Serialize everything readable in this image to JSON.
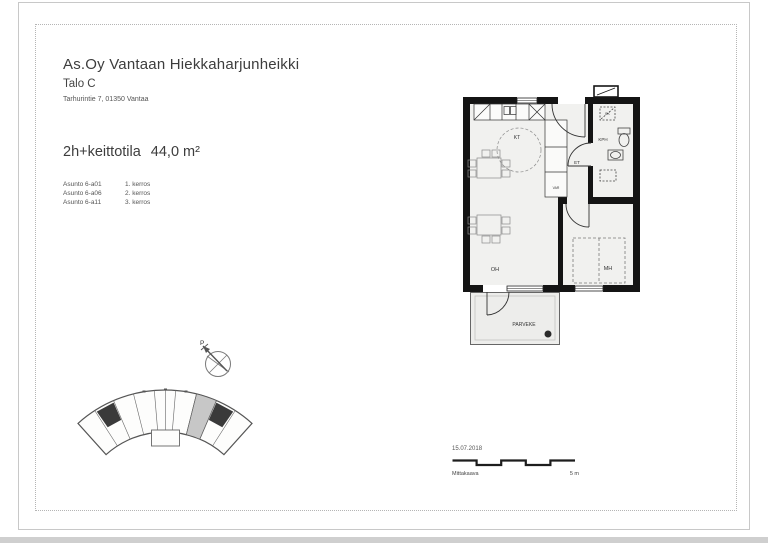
{
  "header": {
    "company": "As.Oy Vantaan Hiekkaharjunheikki",
    "building": "Talo C",
    "address": "Tarhurintie 7,  01350 Vantaa"
  },
  "apartment": {
    "type": "2h+keittotila",
    "area": "44,0 m²",
    "units": [
      {
        "name": "Asunto 6-a01",
        "floor": "1. kerros"
      },
      {
        "name": "Asunto 6-a06",
        "floor": "2. kerros"
      },
      {
        "name": "Asunto 6-a11",
        "floor": "3. kerros"
      }
    ]
  },
  "floorplan": {
    "rooms": {
      "kitchen": "KT",
      "hall": "ET",
      "bathroom": "KPH",
      "living_room": "OH",
      "bedroom": "MH",
      "balcony": "PARVEKE",
      "closet": "VAR",
      "washing_machine": "PK"
    }
  },
  "compass": {
    "north_label": "P"
  },
  "footer": {
    "date": "15.07.2018",
    "scale_label": "Mittakaava",
    "scale_value": "5 m"
  },
  "colors": {
    "wall": "#141414",
    "room_fill": "#f1f1ef",
    "balcony_fill": "#ededeb",
    "highlight_unit": "#c7c7c7"
  }
}
